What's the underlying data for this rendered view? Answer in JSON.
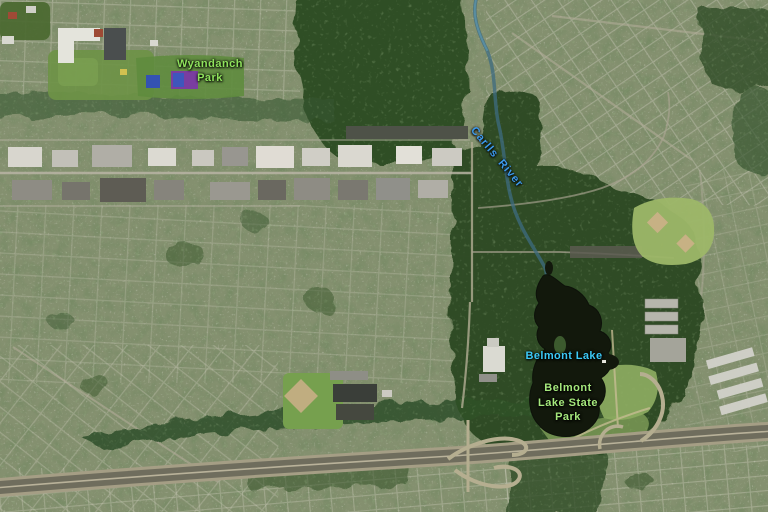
{
  "map": {
    "kind": "satellite-aerial-imagery",
    "labels": {
      "wyandanch_park": {
        "line1": "Wyandanch",
        "line2": "Park",
        "color": "#8fe25c"
      },
      "carlls_river": {
        "text": "Carlls River",
        "color": "#3d9bee",
        "rotation_deg": 50
      },
      "belmont_lake": {
        "text": "Belmont Lake",
        "color": "#3cc9f6"
      },
      "belmont_lake_state_park": {
        "line1": "Belmont",
        "line2": "Lake State",
        "line3": "Park",
        "color": "#a5e87c"
      }
    },
    "colors": {
      "suburb_base": "#84906f",
      "forest": "#2d4a21",
      "water": "#12180c",
      "highway_asphalt": "#6f6d5d",
      "industrial_roof_light": "#d8d6ce",
      "ballfield_grass": "#9db768",
      "infield_dirt": "#c7b184",
      "tennis_court_blue": "#3452b2",
      "court_purple": "#7a3da0"
    }
  }
}
